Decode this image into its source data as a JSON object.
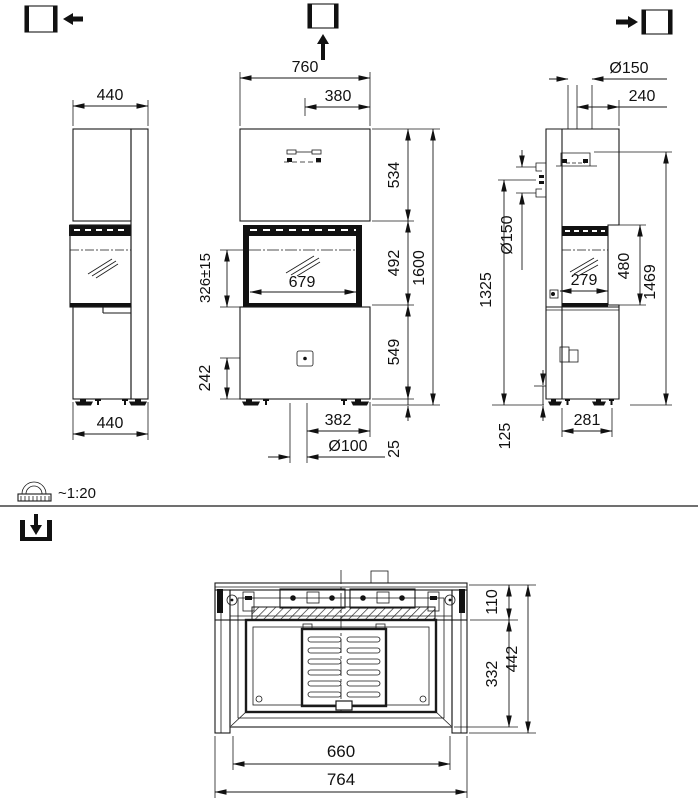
{
  "scale": {
    "label": "~1:20"
  },
  "dims": {
    "left_view": {
      "top_width": "440",
      "bottom_width": "440"
    },
    "front_view": {
      "overall_width": "760",
      "flue_offset": "380",
      "upper_module_height": "534",
      "door_module_height": "492",
      "base_module_height": "549",
      "overall_height": "1600",
      "glass_width": "679",
      "firebox_floor_height": "326±15",
      "damper_height": "242",
      "outlet_offset": "382",
      "outlet_diameter": "Ø100",
      "plinth_height": "25"
    },
    "right_view": {
      "flue_diameter_top": "Ø150",
      "flue_rear_offset": "240",
      "intake_diameter": "Ø150",
      "intake_center_height": "1325",
      "door_opening_height": "480",
      "glass_depth": "279",
      "flue_top_height": "1469",
      "base_depth": "281",
      "bottom_clearance": "125"
    },
    "plan_view": {
      "rear_zone_depth": "110",
      "body_depth": "332",
      "overall_depth": "442",
      "inner_width": "660",
      "overall_width": "764"
    }
  }
}
